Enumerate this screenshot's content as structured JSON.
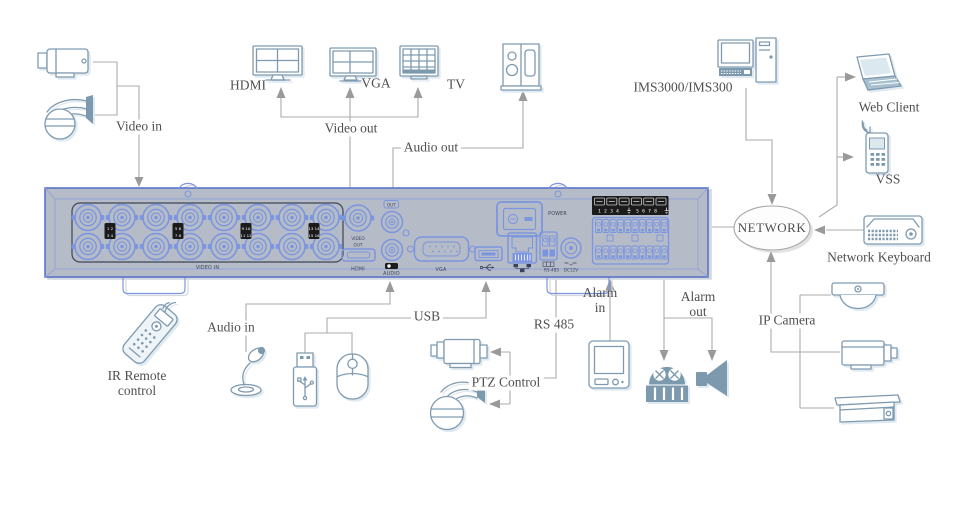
{
  "diagram_title": "DVR rear-panel connection diagram",
  "colors": {
    "line": "#ababab",
    "arrow": "#9a9a9a",
    "icon": "#7f9ab0",
    "icon_fill": "#7d99ad",
    "icon_light": "#eef4f8",
    "connector": "#7b95e0",
    "panel_face": "#b6bcc7",
    "panel_border": "#5a74c8",
    "panel_text": "#39425c",
    "text": "#4f4f4f"
  },
  "labels": {
    "video_in": "Video in",
    "video_out": "Video out",
    "audio_out": "Audio out",
    "hdmi": "HDMI",
    "vga": "VGA",
    "tv": "TV",
    "ims": "IMS3000/IMS300",
    "web_client": "Web Client",
    "vss": "VSS",
    "network": "NETWORK",
    "network_keyboard": "Network Keyboard",
    "ip_camera": "IP Camera",
    "ir_remote_1": "IR Remote",
    "ir_remote_2": "control",
    "audio_in": "Audio in",
    "usb": "USB",
    "rs485": "RS 485",
    "ptz_control": "PTZ Control",
    "alarm_in_1": "Alarm",
    "alarm_in_2": "in",
    "alarm_out_1": "Alarm",
    "alarm_out_2": "out"
  },
  "panel": {
    "video_in_label": "VIDEO IN",
    "video_out_label_1": "VIDEO",
    "video_out_label_2": "OUT",
    "hdmi_label": "HDMI",
    "audio_out_tag": "OUT",
    "audio_label": "AUDIO",
    "vga_label": "VGA",
    "rs485_label": "RS-485",
    "dc12v_label": "DC12V",
    "power_label": "POWER",
    "alarm_numbers_left": "1 2 3 4",
    "alarm_numbers_right": "5 6 7 8",
    "channel_tags": [
      [
        "1 2",
        "3 4"
      ],
      [
        "5 6",
        "7 8"
      ],
      [
        "9 10",
        "11 12"
      ],
      [
        "13 14",
        "15 16"
      ]
    ],
    "bnc_rows": 2,
    "bnc_columns": 8,
    "alarm_terminals_per_row": 10
  },
  "device_icons": [
    "analog-bullet-camera",
    "analog-dome-camera",
    "hdmi-monitor",
    "vga-monitor",
    "tv",
    "speaker",
    "ims-server-pc",
    "laptop",
    "mobile-phone",
    "network-keyboard",
    "ip-dome-camera",
    "ip-box-camera",
    "ip-housing-camera",
    "ir-remote",
    "microphone",
    "usb-flash-drive",
    "usb-mouse",
    "ptz-box-camera",
    "ptz-dome-camera",
    "alarm-input-device",
    "alarm-siren",
    "alarm-horn"
  ]
}
